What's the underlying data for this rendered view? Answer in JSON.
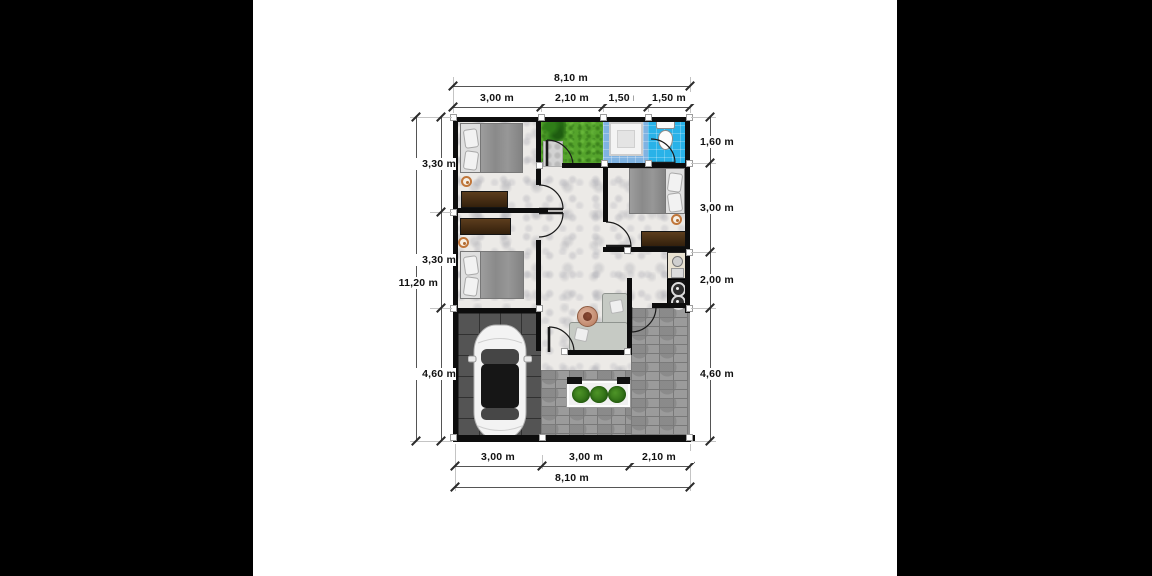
{
  "plan": {
    "type": "house-floor-plan-top-view"
  },
  "dimensions": {
    "top_total": "8,10 m",
    "top_segments": [
      "3,00 m",
      "2,10 m",
      "1,50 m",
      "1,50 m"
    ],
    "left_total": "11,20 m",
    "left_segments": [
      "3,30 m",
      "3,30 m",
      "4,60 m"
    ],
    "right_segments": [
      "1,60 m",
      "3,00 m",
      "2,00 m",
      "4,60 m"
    ],
    "bottom_segments": [
      "3,00 m",
      "3,00 m",
      "2,10 m"
    ],
    "bottom_total": "8,10 m"
  },
  "colors": {
    "background": "#000000",
    "paper": "#ffffff",
    "wall": "#0d0d0d",
    "grass": "#55a42c",
    "shower_floor": "#7fb3e2",
    "toilet_floor": "#29b2e8",
    "garage_floor": "#545454",
    "paver": "#9b9b9b",
    "dresser_wood": "#4a3118",
    "dimension_text": "#111111"
  }
}
